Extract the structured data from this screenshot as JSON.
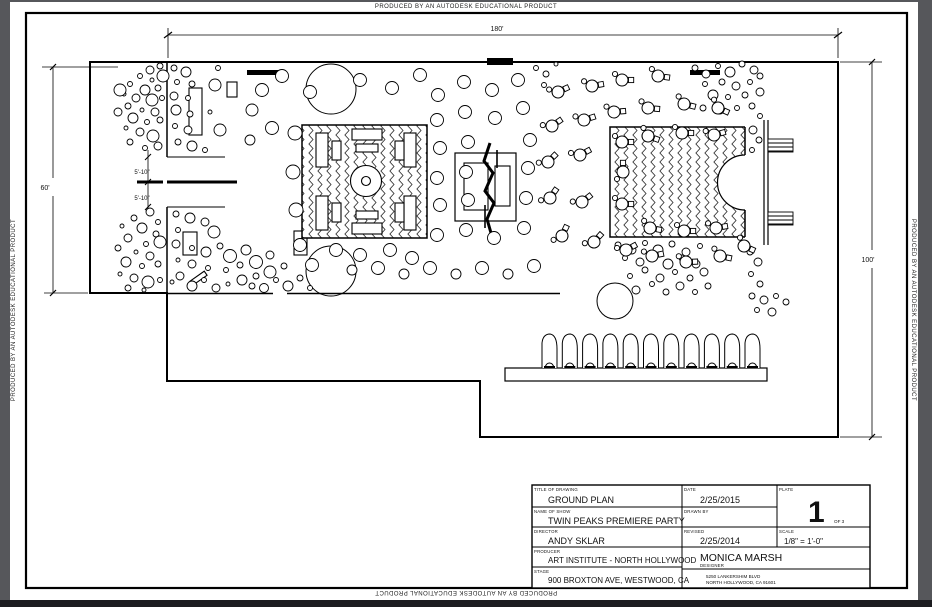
{
  "banner": {
    "text": "PRODUCED BY AN AUTODESK EDUCATIONAL PRODUCT"
  },
  "drawing": {
    "type": "ground-plan-cad-sheet",
    "dimensions": {
      "top_width": "180'",
      "left_height": "60'",
      "right_height": "100'",
      "entry_upper": "5'-10\"",
      "entry_lower": "5'-10\""
    }
  },
  "title_block": {
    "title_label": "TITLE OF DRAWING",
    "title": "GROUND PLAN",
    "show_label": "NAME OF SHOW",
    "show": "TWIN PEAKS PREMIERE PARTY",
    "director_label": "DIRECTOR",
    "director": "ANDY SKLAR",
    "producer_label": "PRODUCER",
    "producer": "ART INSTITUTE - NORTH HOLLYWOOD",
    "stage_label": "STAGE",
    "stage_address": "900 BROXTON AVE, WESTWOOD, CA",
    "date_label": "DATE",
    "date": "2/25/2015",
    "drawn_by_label": "DRAWN BY",
    "drawn_by": "",
    "revised_label": "REVISED",
    "revised": "2/25/2014",
    "plate_label": "PLATE",
    "plate_number": "1",
    "plate_of": "OF 3",
    "scale_label": "SCALE",
    "scale": "1/8\" = 1'-0\"",
    "designer_name": "MONICA MARSH",
    "designer_label": "DESIGNER",
    "designer_address_line1": "5250 LANKERSHIM BLVD",
    "designer_address_line2": "NORTH HOLLYWOOD, CA 91601"
  },
  "colors": {
    "paper": "#ffffff",
    "ink": "#000000",
    "frame": "#56575b",
    "footer": "#1c1c20"
  }
}
